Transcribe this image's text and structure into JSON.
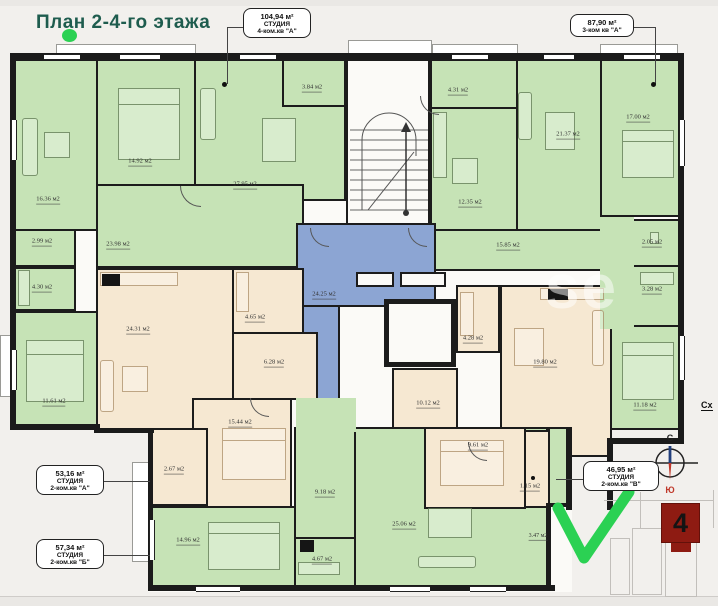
{
  "title": "План 2-4-го этажа",
  "callouts": {
    "studio104": {
      "area": "104,94 м²",
      "type": "СТУДИЯ",
      "unit": "4-ком.кв \"А\""
    },
    "apt87": {
      "area": "87,90 м²",
      "unit": "3-ком кв \"А\""
    },
    "studio53": {
      "area": "53,16 м²",
      "type": "СТУДИЯ",
      "unit": "2-ком.кв \"А\""
    },
    "studio57": {
      "area": "57,34 м²",
      "type": "СТУДИЯ",
      "unit": "2-ком.кв \"Б\""
    },
    "studio46": {
      "area": "46,95 м²",
      "type": "СТУДИЯ",
      "unit": "2-ком.кв \"В\""
    }
  },
  "rooms": {
    "r1636": "16.36 м2",
    "r1492": "14.92 м2",
    "r2795": "27.95 м2",
    "r2398": "23.98 м2",
    "r299": "2.99 м2",
    "r430": "4.30 м2",
    "r1161": "11.61 м2",
    "r384": "3.84 м2",
    "r431": "4.31 м2",
    "r2137": "21.37 м2",
    "r1700": "17.00 м2",
    "r1235": "12.35 м2",
    "r1585": "15.85 м2",
    "r205": "2.05 м2",
    "r328": "3.28 м2",
    "r1118": "11.18 м2",
    "r2425": "24.25 м2",
    "r2431": "24.31 м2",
    "r465": "4.65 м2",
    "r628": "6.28 м2",
    "r1544": "15.44 м2",
    "r267": "2.67 м2",
    "r1980": "19.80 м2",
    "r1012": "10.12 м2",
    "r428": "4.28 м2",
    "r961": "9.61 м2",
    "r115": "1.15 м2",
    "r918": "9.18 м2",
    "r467": "4.67 м2",
    "r1496": "14.96 м2",
    "r2506": "25.06 м2",
    "r347": "3.47 м2"
  },
  "compass": {
    "north": "С",
    "south": "Ю"
  },
  "minimap": {
    "building_number": "4"
  },
  "side_note": "Сх",
  "watermark": "se",
  "colors": {
    "room_green": "#c6e3b6",
    "room_beige": "#f6e8d2",
    "hall_blue": "#8ca5d3",
    "wall": "#1b1b1b",
    "accent_green": "#2bd153",
    "marker_red": "#8e1b12",
    "title": "#1e5c4e"
  }
}
